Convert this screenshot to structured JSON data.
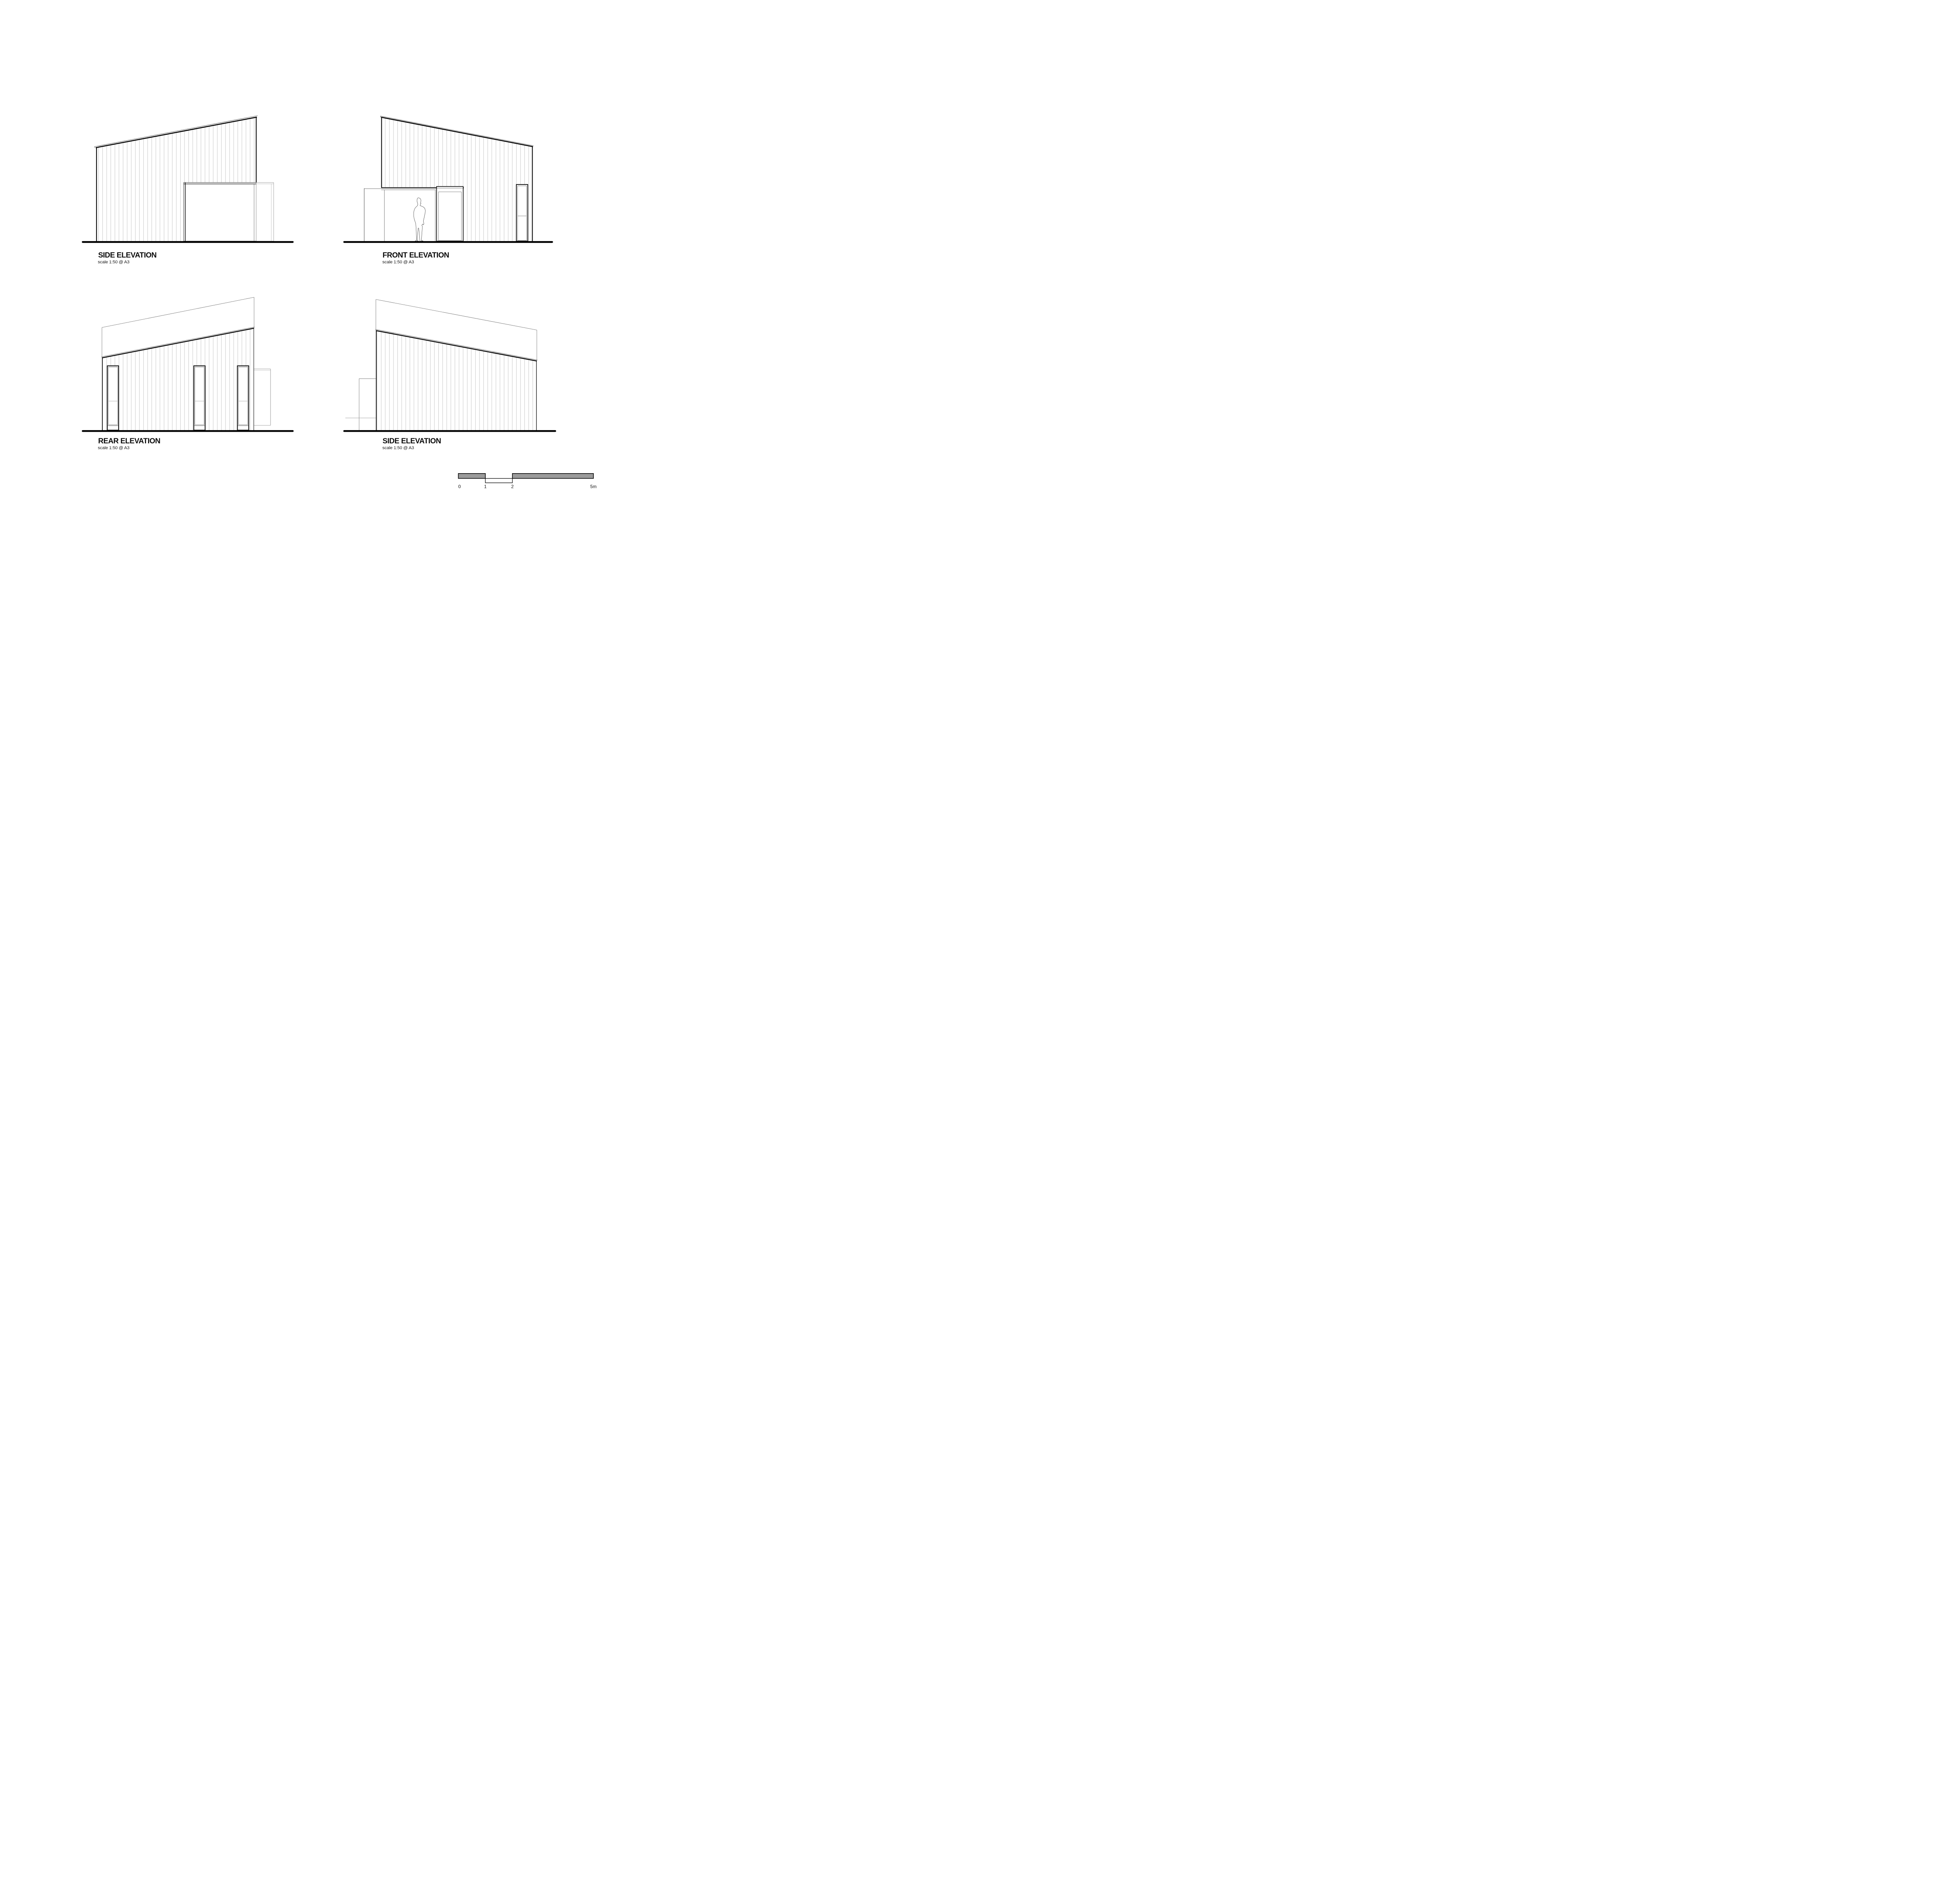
{
  "drawings": [
    {
      "title": "SIDE ELEVATION",
      "scale_label": "scale 1:50 @ A3"
    },
    {
      "title": "FRONT ELEVATION",
      "scale_label": "scale 1:50 @ A3"
    },
    {
      "title": "REAR ELEVATION",
      "scale_label": "scale 1:50 @ A3"
    },
    {
      "title": "SIDE ELEVATION",
      "scale_label": "scale 1:50 @ A3"
    }
  ],
  "scale_bar": {
    "labels": [
      "0",
      "1",
      "2",
      "5m"
    ],
    "bar_color": "#9b9b9b",
    "line_color": "#000000"
  },
  "colors": {
    "paper": "#ffffff",
    "heavy_line": "#000000",
    "medium_line": "#2a2a2a",
    "cladding_line": "#b8b8b8",
    "background_outline": "#666666"
  }
}
